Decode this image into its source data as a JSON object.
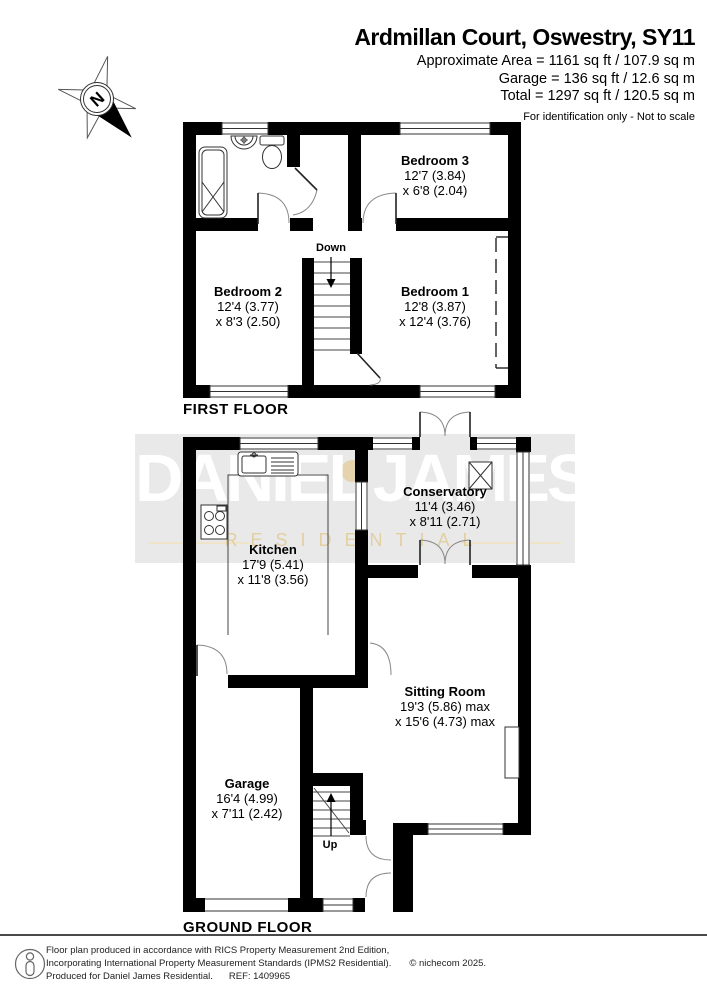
{
  "header": {
    "title": "Ardmillan Court, Oswestry, SY11",
    "area_line": "Approximate Area = 1161 sq ft / 107.9 sq m",
    "garage_line": "Garage = 136 sq ft / 12.6 sq m",
    "total_line": "Total = 1297 sq ft / 120.5 sq m",
    "note": "For identification only - Not to scale"
  },
  "compass": {
    "label": "N"
  },
  "watermark": {
    "brand": "DANIEL JAMES",
    "sub": "RESIDENTIAL"
  },
  "floors": {
    "first": {
      "label": "FIRST FLOOR",
      "stairs_label": "Down",
      "rooms": [
        {
          "name": "Bedroom 3",
          "dim1": "12'7 (3.84)",
          "dim2": "x 6'8 (2.04)"
        },
        {
          "name": "Bedroom 2",
          "dim1": "12'4 (3.77)",
          "dim2": "x 8'3 (2.50)"
        },
        {
          "name": "Bedroom 1",
          "dim1": "12'8 (3.87)",
          "dim2": "x 12'4 (3.76)"
        }
      ]
    },
    "ground": {
      "label": "GROUND FLOOR",
      "stairs_label": "Up",
      "rooms": [
        {
          "name": "Conservatory",
          "dim1": "11'4 (3.46)",
          "dim2": "x 8'11 (2.71)"
        },
        {
          "name": "Kitchen",
          "dim1": "17'9 (5.41)",
          "dim2": "x 11'8 (3.56)"
        },
        {
          "name": "Sitting Room",
          "dim1": "19'3 (5.86) max",
          "dim2": "x 15'6 (4.73) max"
        },
        {
          "name": "Garage",
          "dim1": "16'4 (4.99)",
          "dim2": "x 7'11 (2.42)"
        }
      ]
    }
  },
  "footer": {
    "line1": "Floor plan produced in accordance with RICS Property Measurement 2nd Edition,",
    "line2": "Incorporating International Property Measurement Standards (IPMS2 Residential).",
    "copyright": "© nichecom 2025.",
    "line3": "Produced for Daniel James Residential.",
    "ref": "REF:  1409965"
  },
  "colors": {
    "wall": "#000000",
    "watermark_bg": "#e9e9e9",
    "watermark_text": "#ffffff",
    "watermark_gold": "#e2ce9e"
  }
}
